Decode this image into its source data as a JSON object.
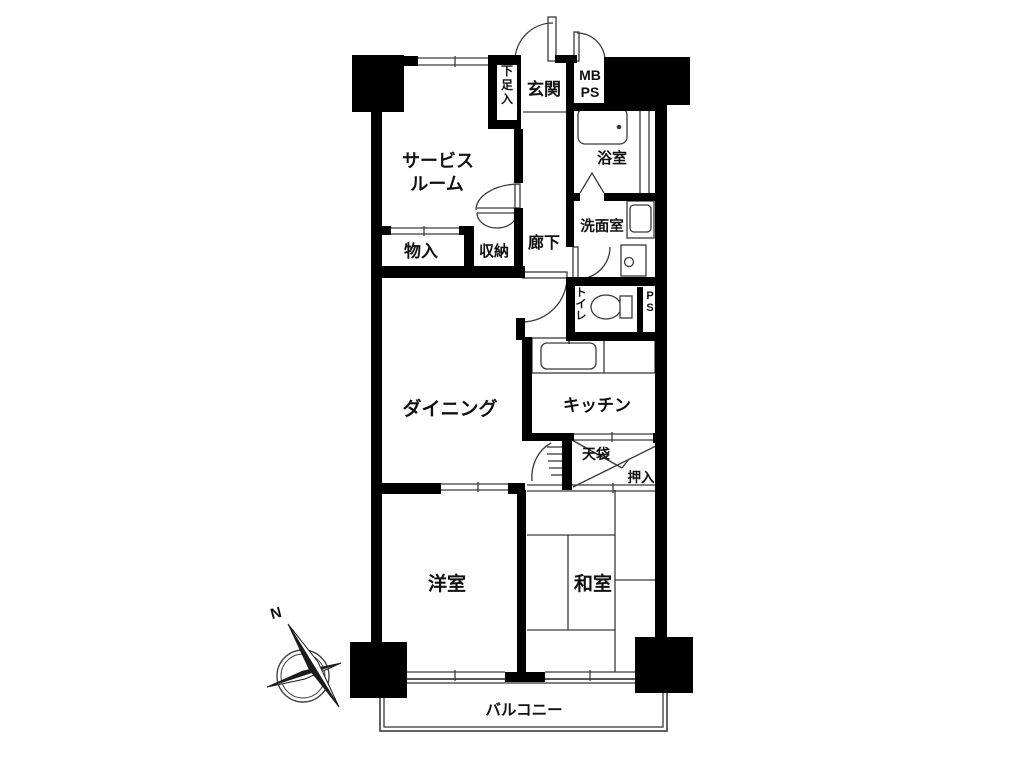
{
  "floor_plan": {
    "labels": {
      "service_room_line1": "サービス",
      "service_room_line2": "ルーム",
      "entrance": "玄関",
      "shoe_storage": "下足入",
      "meter_box_line1": "MB",
      "meter_box_line2": "PS",
      "bathroom": "浴室",
      "washroom": "洗面室",
      "hallway": "廊下",
      "storage": "物入",
      "closet": "収納",
      "toilet": "トイレ",
      "pipe_space": "PS",
      "dining": "ダイニング",
      "kitchen": "キッチン",
      "overhead_closet": "天袋",
      "futon_closet": "押入",
      "western_room": "洋室",
      "japanese_room": "和室",
      "balcony": "バルコニー"
    },
    "compass": {
      "north_label": "N"
    },
    "colors": {
      "wall": "#000000",
      "line": "#3a3a3a",
      "text": "#111111",
      "background": "#ffffff"
    }
  }
}
